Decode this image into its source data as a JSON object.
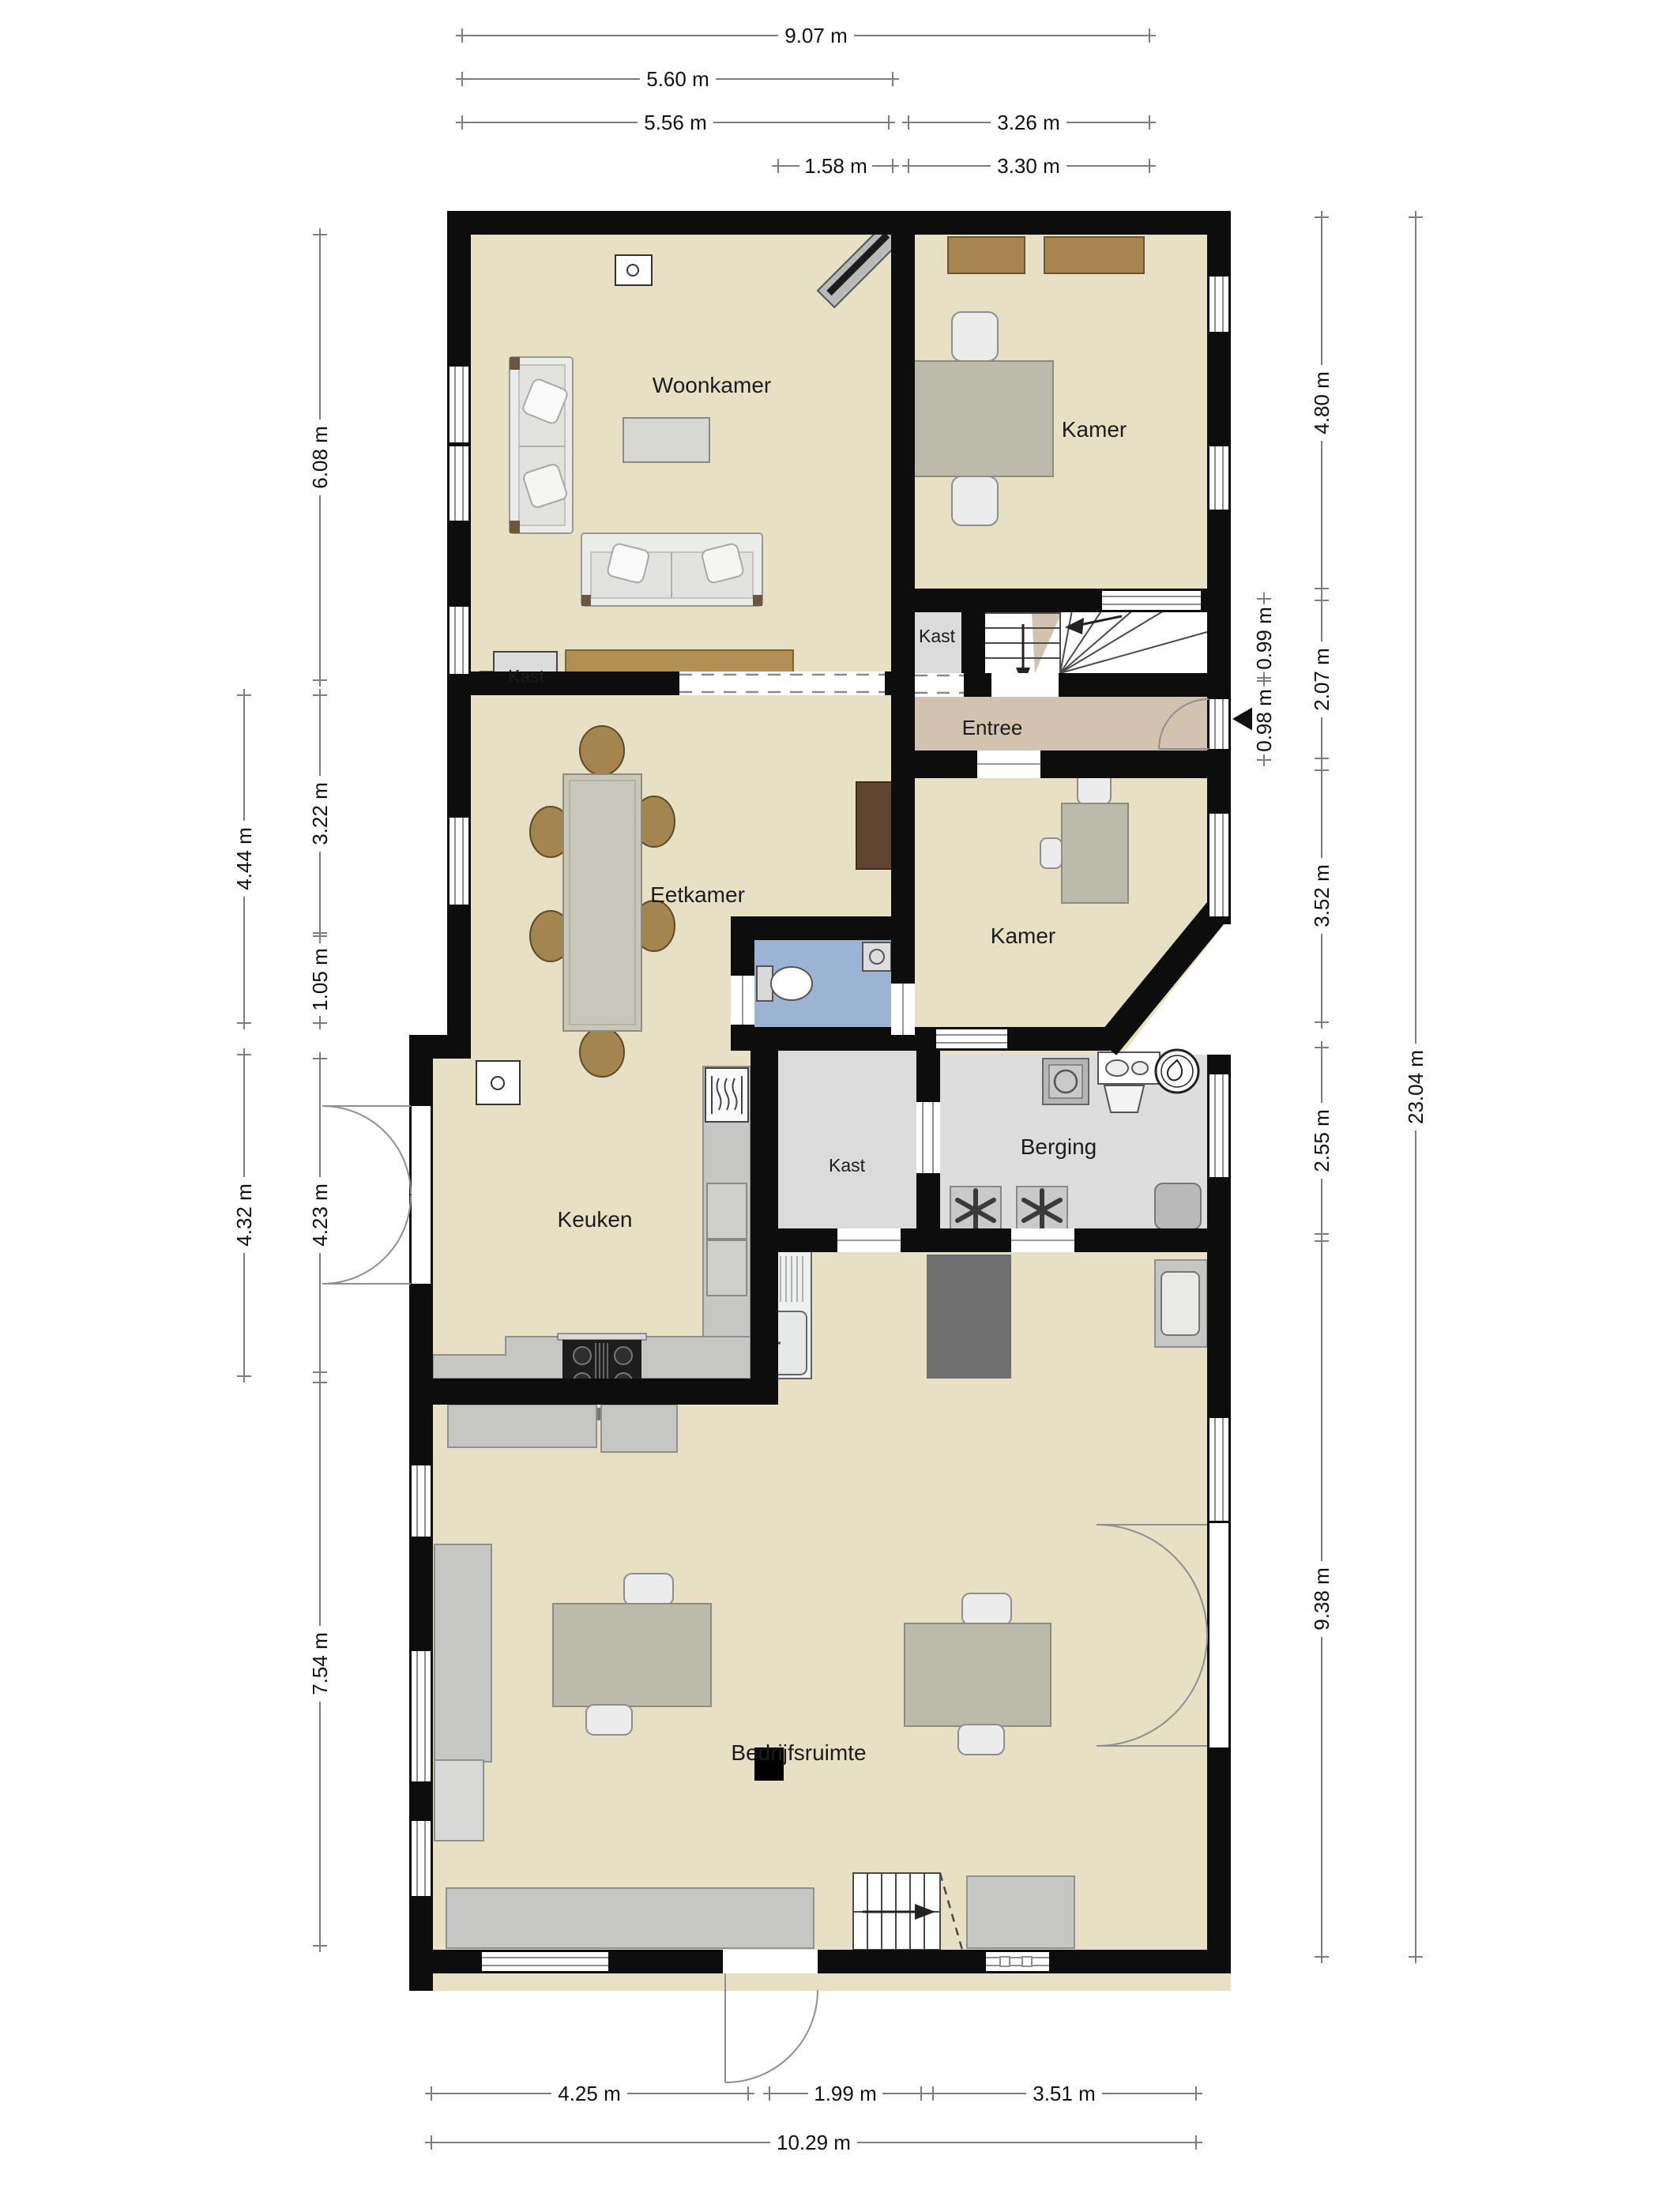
{
  "palette": {
    "wall": "#0d0d0d",
    "floor_main": "#e8e0c5",
    "floor_entree": "#d2c2b0",
    "floor_closet": "#dbdbdb",
    "floor_storage": "#dcdddc",
    "floor_toilet": "#9db3d3",
    "counter_gray": "#c6c6c4",
    "furniture_gray": "#bcbaab",
    "wood_light": "#ab8751",
    "wood_dark": "#5f4632",
    "dimension_line": "#7d7d7d"
  },
  "rooms": {
    "woonkamer": "Woonkamer",
    "kamer_top": "Kamer",
    "kast_top": "Kast",
    "entree": "Entree",
    "eetkamer": "Eetkamer",
    "kamer_mid": "Kamer",
    "keuken": "Keuken",
    "kast_mid": "Kast",
    "berging": "Berging",
    "bedrijfsruimte": "Bedrijfsruimte",
    "kast_woonkamer": "Kast"
  },
  "dims": {
    "w907": "9.07 m",
    "w560": "5.60 m",
    "w556": "5.56 m",
    "w326": "3.26 m",
    "w158": "1.58 m",
    "w330": "3.30 m",
    "h608": "6.08 m",
    "h322": "3.22 m",
    "h105": "1.05 m",
    "h444": "4.44 m",
    "h432": "4.32 m",
    "h423": "4.23 m",
    "h754": "7.54 m",
    "h480": "4.80 m",
    "h207": "2.07 m",
    "h099": "0.99 m",
    "h098": "0.98 m",
    "h352": "3.52 m",
    "h255": "2.55 m",
    "h938": "9.38 m",
    "h2304": "23.04 m",
    "w425": "4.25 m",
    "w199": "1.99 m",
    "w351": "3.51 m",
    "w1029": "10.29 m"
  }
}
